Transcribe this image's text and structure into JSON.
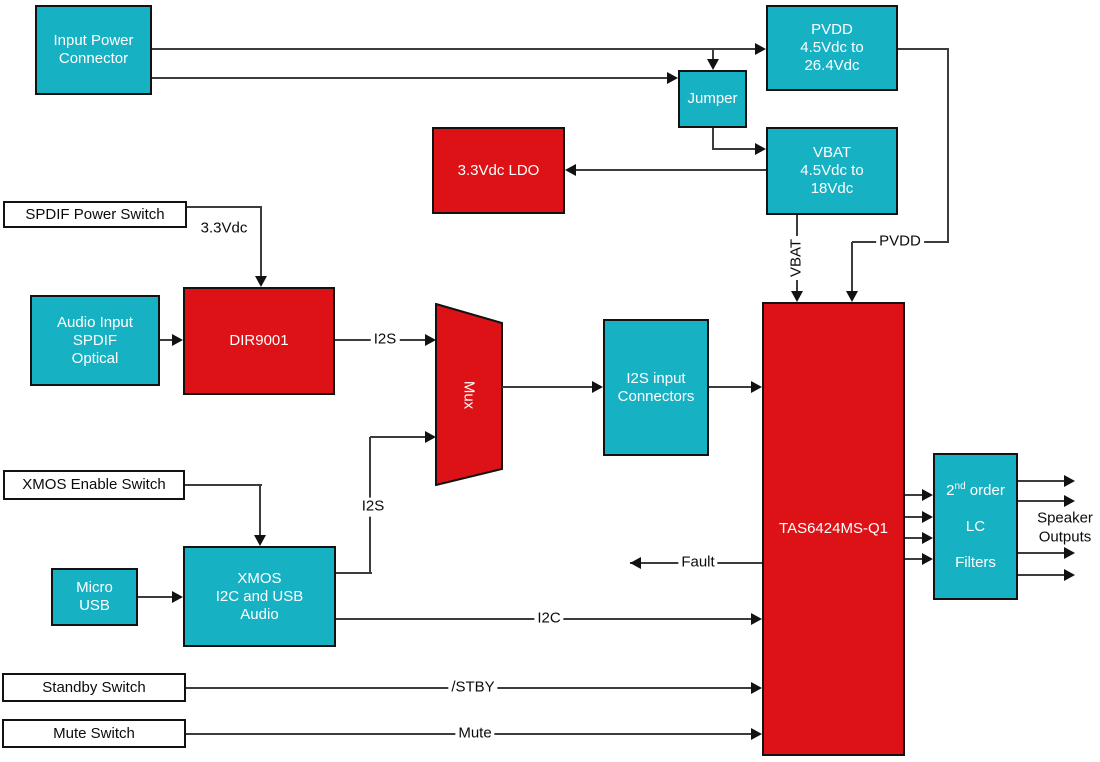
{
  "diagram": {
    "blocks": {
      "input_power_connector": "Input Power\nConnector",
      "pvdd_supply": "PVDD\n4.5Vdc to\n26.4Vdc",
      "jumper": "Jumper",
      "vbat_supply": "VBAT\n4.5Vdc to\n18Vdc",
      "ldo_3v3": "3.3Vdc LDO",
      "spdif_power_switch": "SPDIF Power Switch",
      "audio_input_spdif": "Audio Input\nSPDIF\nOptical",
      "dir9001": "DIR9001",
      "mux": "Mux",
      "i2s_input_connectors": "I2S input\nConnectors",
      "tas6424": "TAS6424MS-Q1",
      "xmos_enable_switch": "XMOS Enable Switch",
      "micro_usb": "Micro\nUSB",
      "xmos_audio": "XMOS\nI2C and USB\nAudio",
      "lc_filters": {
        "order_base": "2",
        "order_sup": "nd",
        "order_rest": " order",
        "line2": "LC",
        "line3": "Filters"
      },
      "standby_switch": "Standby Switch",
      "mute_switch": "Mute Switch"
    },
    "net_labels": {
      "v3_3": "3.3Vdc",
      "i2s_dir": "I2S",
      "i2s_xmos": "I2S",
      "i2c": "I2C",
      "stby": "/STBY",
      "mute": "Mute",
      "fault": "Fault",
      "pvdd": "PVDD",
      "vbat": "VBAT",
      "speaker_outputs": "Speaker\nOutputs"
    },
    "colors": {
      "block_cyan": "#17b1c4",
      "block_red": "#dc1216",
      "wire": "#3c3c3c",
      "border": "#121212"
    }
  }
}
